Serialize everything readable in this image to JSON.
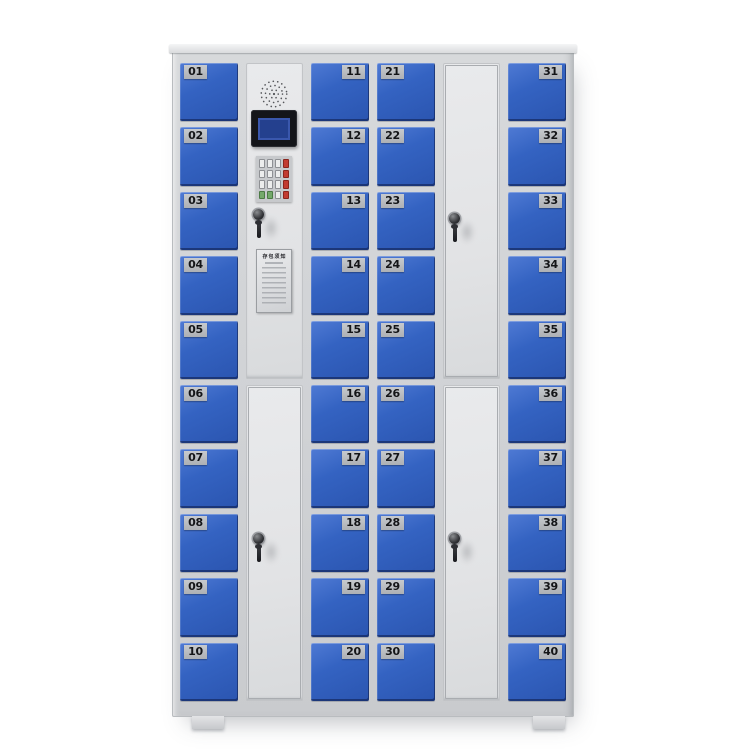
{
  "cabinet": {
    "doors_total": 40,
    "columns": [
      {
        "id": "column-1",
        "type": "small-doors",
        "plate_side": "left",
        "doors": [
          "01",
          "02",
          "03",
          "04",
          "05",
          "06",
          "07",
          "08",
          "09",
          "10"
        ]
      },
      {
        "id": "column-2",
        "type": "control",
        "sections": [
          "control-panel",
          "tall-service-door"
        ]
      },
      {
        "id": "column-3",
        "type": "small-doors",
        "plate_side": "right",
        "doors": [
          "11",
          "12",
          "13",
          "14",
          "15",
          "16",
          "17",
          "18",
          "19",
          "20"
        ]
      },
      {
        "id": "column-4",
        "type": "small-doors",
        "plate_side": "left",
        "doors": [
          "21",
          "22",
          "23",
          "24",
          "25",
          "26",
          "27",
          "28",
          "29",
          "30"
        ]
      },
      {
        "id": "column-5",
        "type": "tall-doors",
        "sections": [
          "tall-door-upper",
          "tall-door-lower"
        ]
      },
      {
        "id": "column-6",
        "type": "small-doors",
        "plate_side": "right",
        "doors": [
          "31",
          "32",
          "33",
          "34",
          "35",
          "36",
          "37",
          "38",
          "39",
          "40"
        ]
      }
    ],
    "control_panel": {
      "speaker": "speaker-grille",
      "display": "lcd-display",
      "keypad_keys": [
        [
          "light",
          "light",
          "light",
          "red"
        ],
        [
          "light",
          "light",
          "light",
          "red"
        ],
        [
          "light",
          "light",
          "light",
          "red"
        ],
        [
          "green",
          "green",
          "light",
          "red"
        ]
      ],
      "lock": "cam-lock-with-key",
      "notice": {
        "title": "存包须知"
      }
    },
    "locks_with_keys": 4,
    "colors": {
      "door_blue": "#3461bf",
      "frame_gray": "#d2d4d7",
      "panel_gray": "#e6e7e9",
      "plate_gray": "#b7babe",
      "number_text": "#17181a",
      "lcd_screen_blue": "#24408e",
      "keypad_red": "#c23b31",
      "keypad_green": "#74a96b"
    }
  }
}
